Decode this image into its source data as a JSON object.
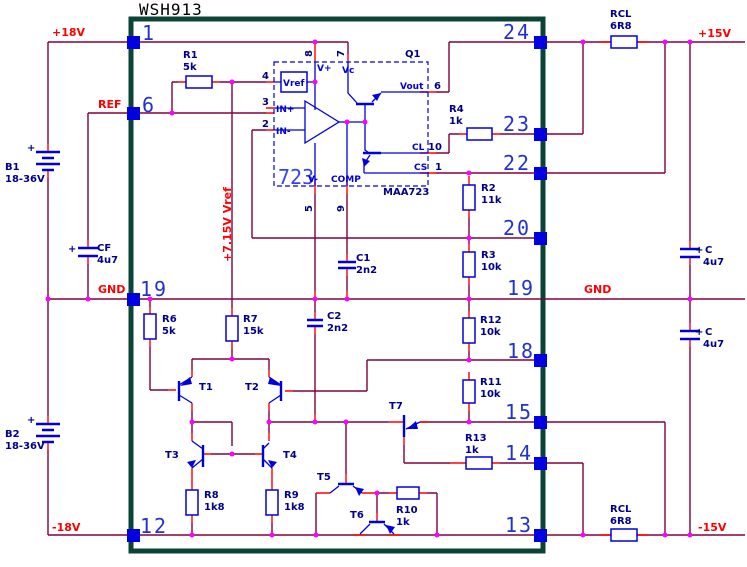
{
  "title": "WSH913",
  "colors": {
    "wire": "#800040",
    "lead": "#ff0000",
    "symbol": "#0000dd",
    "junction": "#ff00ff",
    "border": "#0b4436",
    "pin_square": "#0000e0",
    "component_label": "#00008b",
    "net_label": "#ff0000",
    "pin_number": "#2233cc"
  },
  "nets": {
    "p18": "+18V",
    "ref": "REF",
    "gnd_left": "GND",
    "m18": "-18V",
    "p15": "+15V",
    "m15": "-15V",
    "gnd_right": "GND",
    "vref_rail": "+7.15V Vref"
  },
  "pins_left": [
    "1",
    "6",
    "19",
    "12"
  ],
  "pins_right": [
    "24",
    "23",
    "22",
    "20",
    "19",
    "18",
    "15",
    "14",
    "13"
  ],
  "ic": {
    "big": "723",
    "part": "MAA723",
    "q1": "Q1",
    "vref": "Vref",
    "vplus": "V+",
    "vc": "Vc",
    "vminus": "V-",
    "comp": "COMP",
    "in_p": "IN+",
    "in_m": "IN-",
    "vout": "Vout",
    "cl": "CL",
    "cs": "CS",
    "p2": "2",
    "p3": "3",
    "p4": "4",
    "p5": "5",
    "p6": "6",
    "p7": "7",
    "p8": "8",
    "p9": "9",
    "p10": "10",
    "p1": "1"
  },
  "components": {
    "plus": "+",
    "r1": [
      "R1",
      "5k"
    ],
    "r2": [
      "R2",
      "11k"
    ],
    "r3": [
      "R3",
      "10k"
    ],
    "r4": [
      "R4",
      "1k"
    ],
    "r6": [
      "R6",
      "5k"
    ],
    "r7": [
      "R7",
      "15k"
    ],
    "r8": [
      "R8",
      "1k8"
    ],
    "r9": [
      "R9",
      "1k8"
    ],
    "r10": [
      "R10",
      "1k"
    ],
    "r11": [
      "R11",
      "10k"
    ],
    "r12": [
      "R12",
      "10k"
    ],
    "r13": [
      "R13",
      "1k"
    ],
    "rcl_top": [
      "RCL",
      "6R8"
    ],
    "rcl_bot": [
      "RCL",
      "6R8"
    ],
    "c1": [
      "C1",
      "2n2"
    ],
    "c2": [
      "C2",
      "2n2"
    ],
    "cf": [
      "CF",
      "4u7"
    ],
    "c_top": [
      "C",
      "4u7"
    ],
    "c_bot": [
      "C",
      "4u7"
    ],
    "b1": [
      "B1",
      "18-36V"
    ],
    "b2": [
      "B2",
      "18-36V"
    ],
    "t1": "T1",
    "t2": "T2",
    "t3": "T3",
    "t4": "T4",
    "t5": "T5",
    "t6": "T6",
    "t7": "T7"
  }
}
